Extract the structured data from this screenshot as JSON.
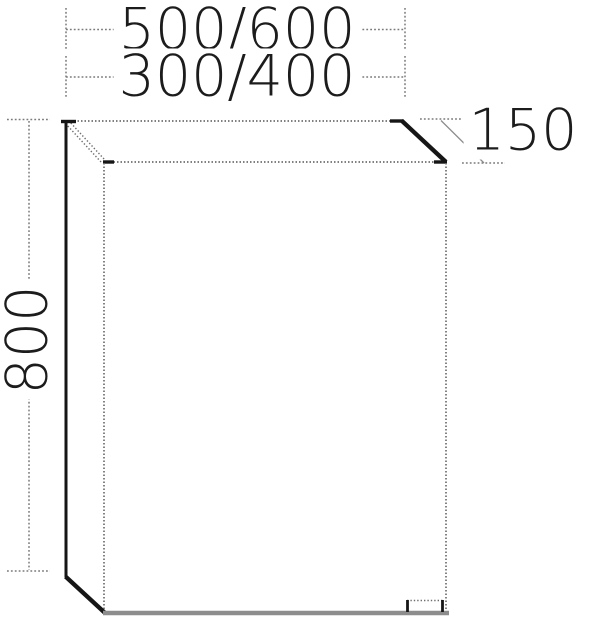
{
  "drawing": {
    "subject": "wall-cabinet-technical-drawing",
    "dimensions": {
      "width_large": "500/600",
      "width_small": "300/400",
      "height": "800",
      "depth": "150"
    },
    "colors": {
      "line_thin": "#6e6e6e",
      "line_thick": "#161616",
      "line_bottom": "#8d8d8d",
      "dim_line": "#7a7a7a",
      "text_color": "#1c1c1c",
      "bg": "#ffffff"
    }
  }
}
